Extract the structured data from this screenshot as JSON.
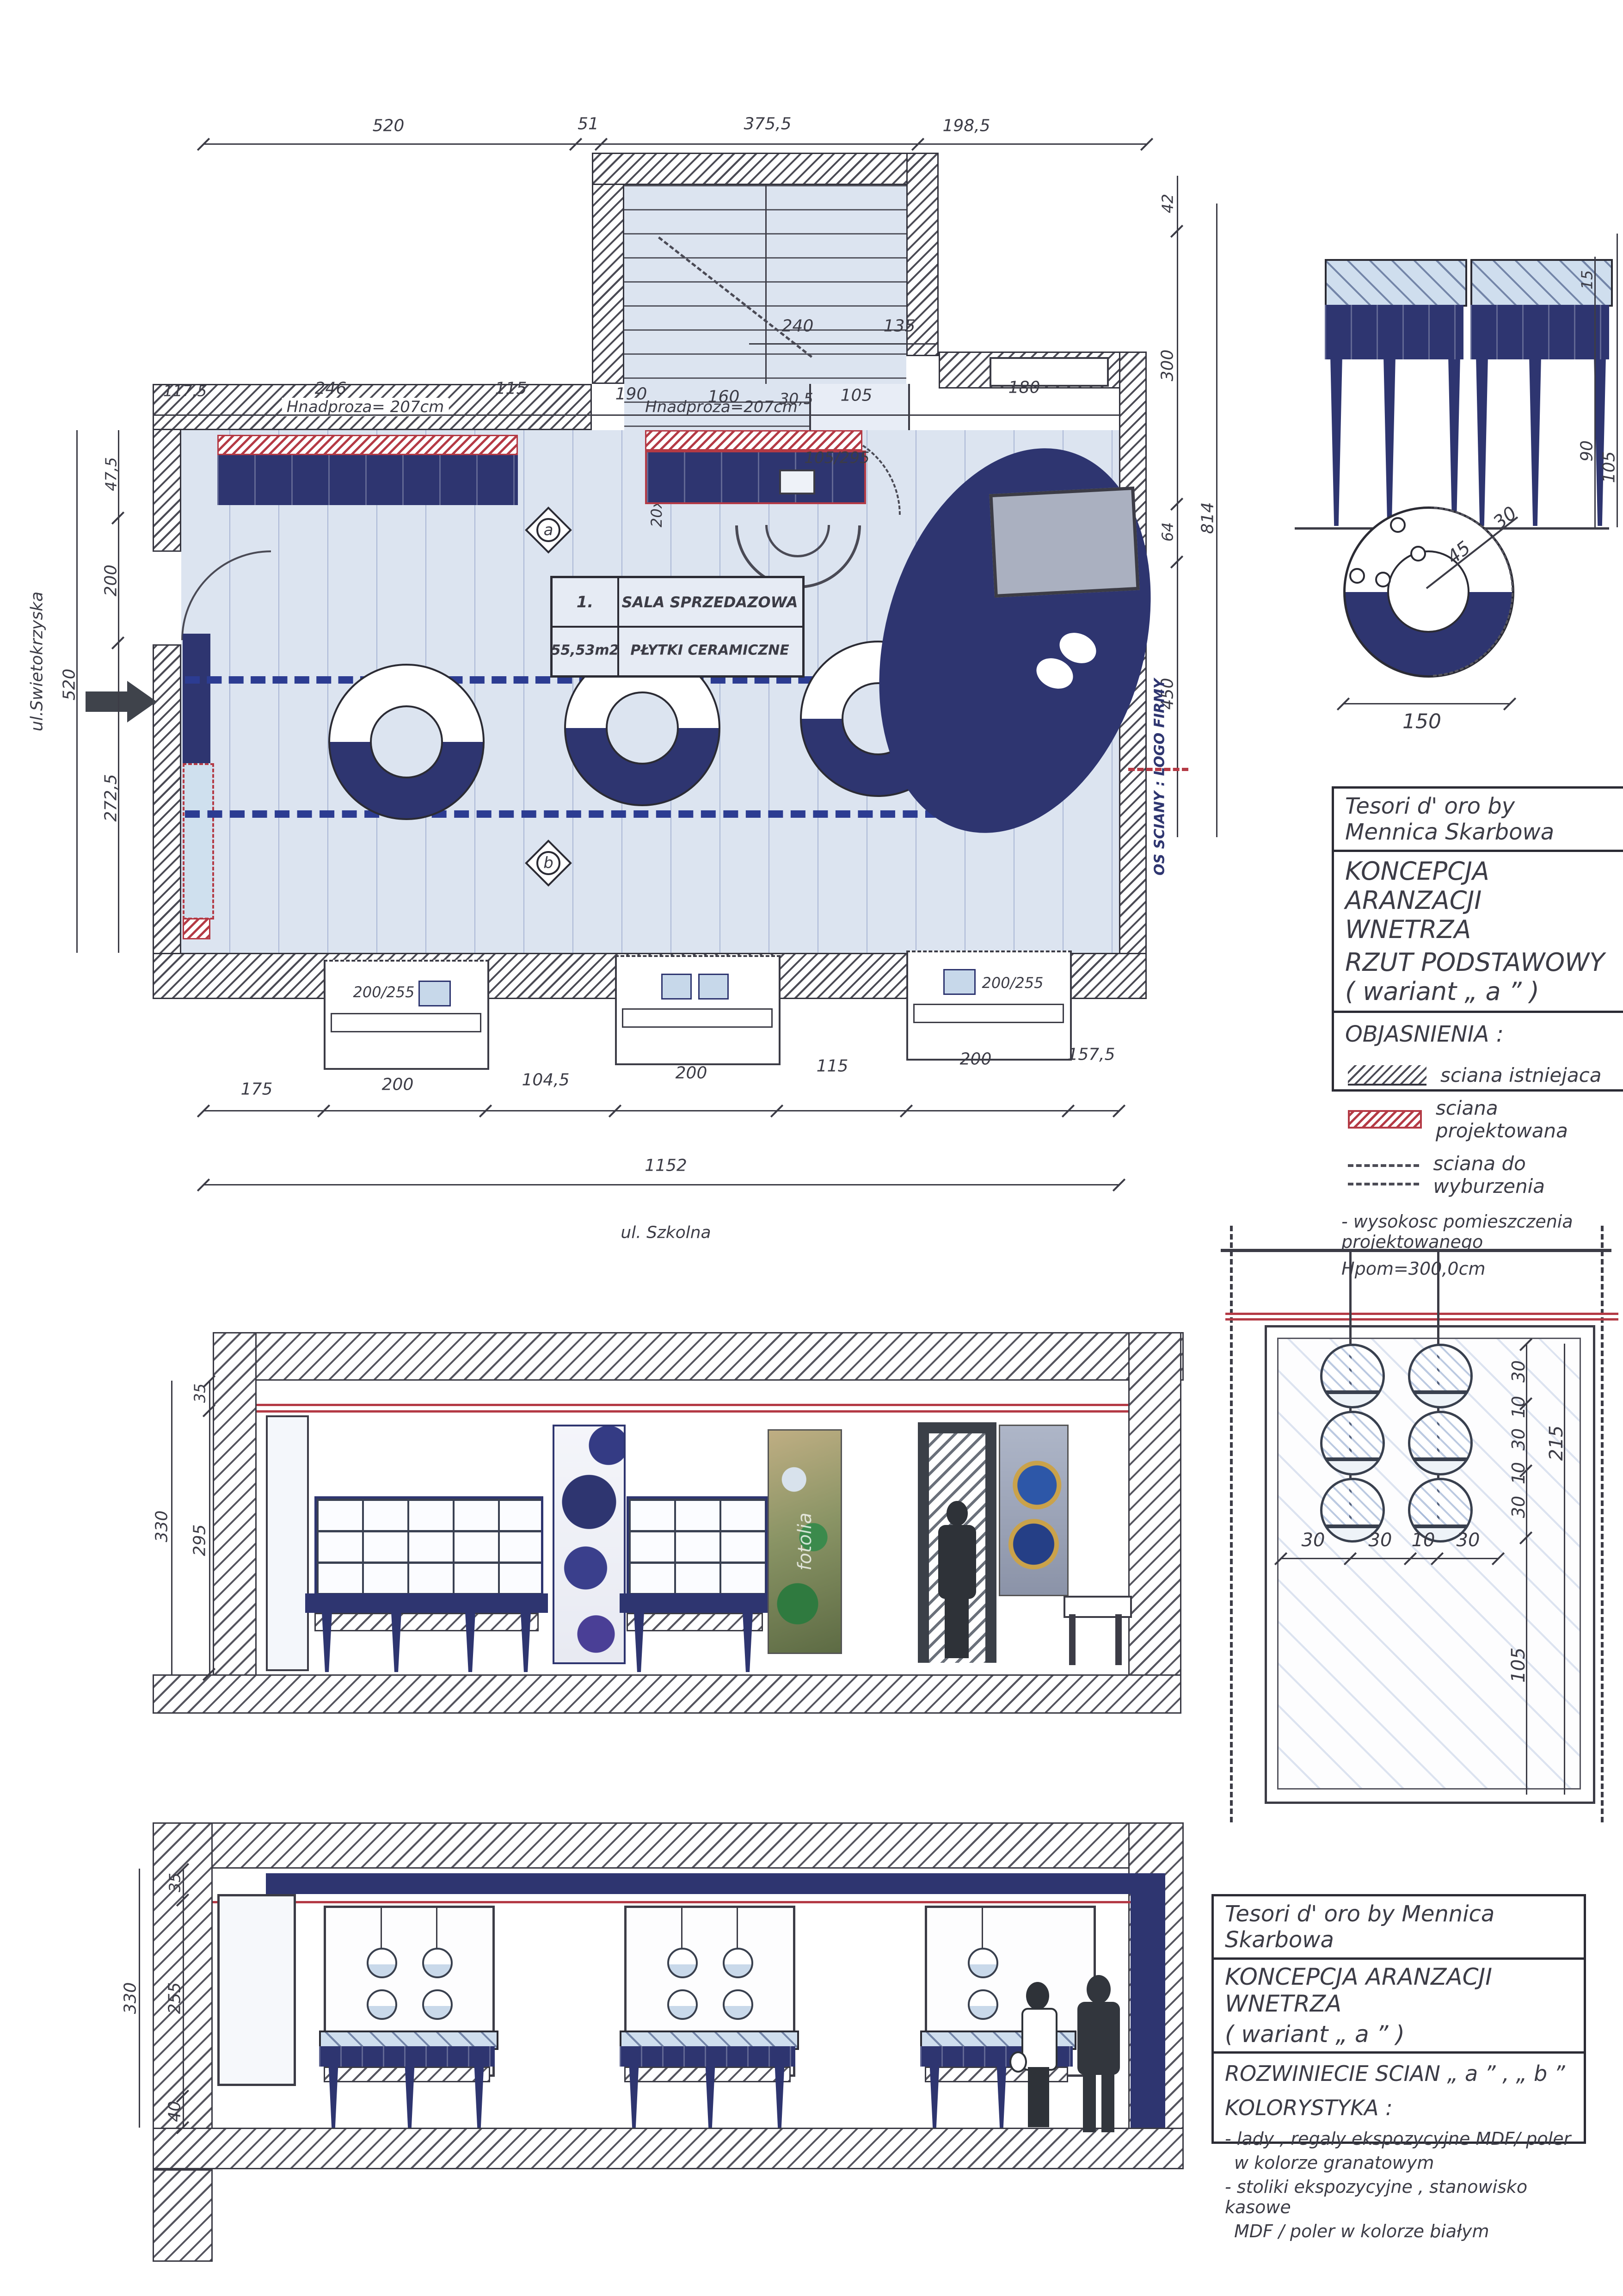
{
  "titleblock1": {
    "brand": "Tesori d' oro by Mennica Skarbowa",
    "title_line1": "KONCEPCJA ARANZACJI WNETRZA",
    "title_line2": "RZUT PODSTAWOWY ( wariant „ a ” )",
    "legend_title": "OBJASNIENIA :",
    "legend": [
      {
        "label": "sciana istniejaca"
      },
      {
        "label": "sciana projektowana"
      },
      {
        "label": "sciana do wyburzenia"
      }
    ],
    "note_line1": "- wysokosc pomieszczenia  projektowanego",
    "note_line2": "Hpom=300,0cm"
  },
  "titleblock2": {
    "brand": "Tesori d' oro by Mennica Skarbowa",
    "title_line1": "KONCEPCJA ARANZACJI WNETRZA",
    "title_line2": "( wariant „ a ” )",
    "subtitle": "ROZWINIECIE SCIAN „ a ” , „ b ”",
    "section_title": "KOLORYSTYKA :",
    "notes": [
      "- lady , regaly ekspozycyjne MDF/ poler",
      "w kolorze  granatowym",
      "- stoliki  ekspozycyjne , stanowisko kasowe",
      "MDF / poler  w kolorze białym"
    ]
  },
  "plan": {
    "street_left": "ul.Swietokrzyska",
    "street_bottom": "ul. Szkolna",
    "lintel_label_1": "Hnadproza= 207cm",
    "lintel_label_2": "Hnadproza=207cm",
    "door_label": "105/295",
    "window_label_left": "200/255",
    "window_label_right": "200/255",
    "stair_note": "20x18x28",
    "axis_label": "OS SCIANY : LOGO FIRMY",
    "marker_a": "a",
    "marker_b": "b",
    "room_table": {
      "number": "1.",
      "name": "SALA SPRZEDAZOWA",
      "area": "55,53m2",
      "finish": "PŁYTKI CERAMICZNE"
    },
    "dims_top": [
      "520",
      "51",
      "375,5",
      "198,5"
    ],
    "dims_wall_top": [
      "117,5",
      "246",
      "115",
      "190",
      "160",
      "30,5",
      "105",
      "180"
    ],
    "dims_stairs": [
      "240",
      "135"
    ],
    "dims_left": [
      "47,5",
      "200",
      "272,5"
    ],
    "dim_left_total": "520",
    "dims_right": [
      "42",
      "300",
      "64",
      "450"
    ],
    "dim_right_total": "814",
    "dims_bottom": [
      "175",
      "200",
      "104,5",
      "200",
      "115",
      "200",
      "157,5"
    ],
    "dim_bottom_total": "1152"
  },
  "table_detail": {
    "dims_right": [
      "15",
      "90"
    ],
    "dim_total": "105"
  },
  "counter_detail": {
    "radius_inner": "45",
    "ring_width": "30",
    "diameter": "150"
  },
  "section_a": {
    "dim_total": "330",
    "dims": [
      "35",
      "295"
    ]
  },
  "section_b": {
    "dim_total": "330",
    "dims": [
      "35",
      "255",
      "40"
    ]
  },
  "wall_detail": {
    "dims_bottom": [
      "30",
      "30",
      "10",
      "30"
    ],
    "dims_right": [
      "30",
      "10",
      "30",
      "10",
      "30"
    ],
    "dim_total": "215",
    "dim_bottom_right": "105"
  },
  "watermark": "fotolia"
}
